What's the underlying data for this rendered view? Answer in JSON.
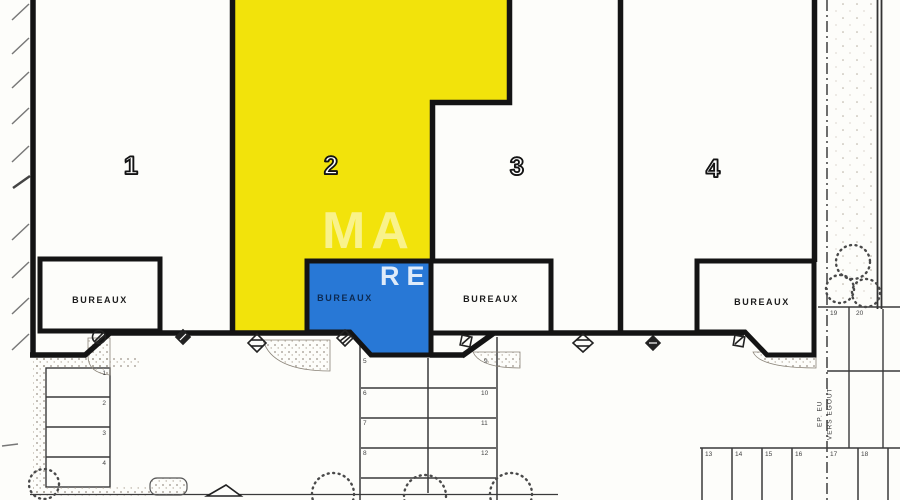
{
  "plan": {
    "units": [
      {
        "number": "1",
        "office_label": "BUREAUX"
      },
      {
        "number": "2",
        "office_label": "BUREAUX"
      },
      {
        "number": "3",
        "office_label": "BUREAUX"
      },
      {
        "number": "4",
        "office_label": "BUREAUX"
      }
    ],
    "watermark": {
      "line1": "MA",
      "line2": "RE"
    },
    "street_label": {
      "line1": "EP. EU",
      "line2": "VERS EGOUT"
    },
    "parking": {
      "left": [
        "1",
        "2",
        "3",
        "4"
      ],
      "central_left": [
        "5",
        "6",
        "7",
        "8"
      ],
      "central_right": [
        "9",
        "10",
        "11",
        "12"
      ],
      "right_upper": [
        "19",
        "20"
      ],
      "bottom_right": [
        "13",
        "14",
        "15",
        "16",
        "17",
        "18"
      ]
    },
    "colors": {
      "unit2_highlight": "#F2E30B",
      "office2_highlight": "#2878D6",
      "wall": "#141414"
    },
    "icons": [
      "utility-manhole-icon",
      "utility-valve-icon",
      "utility-drain-icon",
      "utility-vent-icon",
      "utility-hatch-icon",
      "utility-drain-icon",
      "utility-valve-icon",
      "utility-hatch-icon"
    ]
  }
}
